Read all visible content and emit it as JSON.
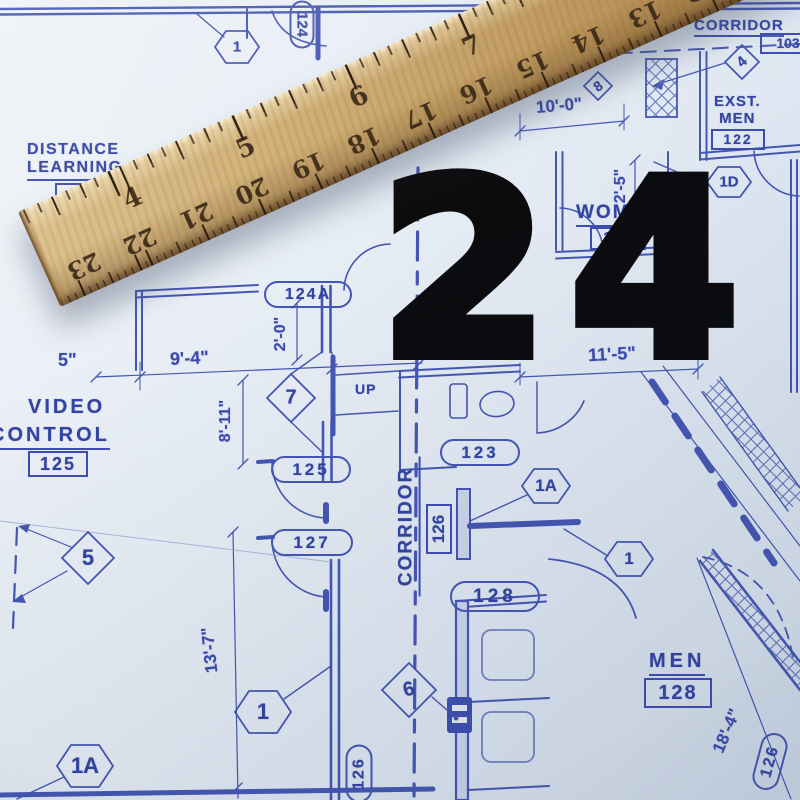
{
  "overlay": {
    "number": "24"
  },
  "ruler": {
    "inch_numbers": [
      "4",
      "5",
      "6",
      "7"
    ],
    "half_inch_numbers": [
      "23",
      "22",
      "21",
      "20",
      "19",
      "18",
      "17",
      "16",
      "15",
      "14",
      "13",
      "12",
      "11",
      "10"
    ]
  },
  "rooms": {
    "distance_learning": {
      "line1": "DISTANCE",
      "line2": "LEARNING",
      "number": "12"
    },
    "video_control": {
      "line1": "VIDEO",
      "line2": "CONTROL",
      "number": "125"
    },
    "corridor_top": {
      "name": "CORRIDOR",
      "number": "103"
    },
    "exst_men": {
      "line1": "EXST.",
      "line2": "MEN",
      "number": "122"
    },
    "women": {
      "name": "WOMEN",
      "number": "123"
    },
    "men": {
      "name": "MEN",
      "number": "128"
    },
    "corridor_center": {
      "name": "CORRIDOR",
      "number": "126"
    },
    "stair": {
      "label": "UP"
    }
  },
  "door_tags": {
    "tag_124": "124",
    "tag_124a": "124A",
    "tag_125": "125",
    "tag_127": "127",
    "tag_123": "123",
    "tag_128": "128",
    "tag_126_bottom_left": "126",
    "tag_126_bottom_right": "126"
  },
  "markers": {
    "hex_top": "1",
    "diamond_top_right": "4",
    "diamond_small": "8",
    "hex_1d": "1D",
    "diamond_7": "7",
    "hex_1a_mid": "1A",
    "hex_1_mid": "1",
    "diamond_5": "5",
    "hex_1a_bottom": "1A",
    "hex_1_bottom": "1",
    "diamond_6": "6"
  },
  "dimensions": {
    "w10_0": "10'-0\"",
    "w2_5": "2'-5\"",
    "w11_5": "11'-5\"",
    "w9_4": "9'-4\"",
    "w2_0": "2'-0\"",
    "w8_11": "8'-11\"",
    "w5": "5\"",
    "w13_7": "13'-7\"",
    "w18_4": "18'-4\""
  },
  "colors": {
    "line": "#4456b2",
    "text": "#3243a2",
    "paper": "#e7edf4",
    "wood": "#c9a46a",
    "overlay": "#0b0b0e"
  }
}
